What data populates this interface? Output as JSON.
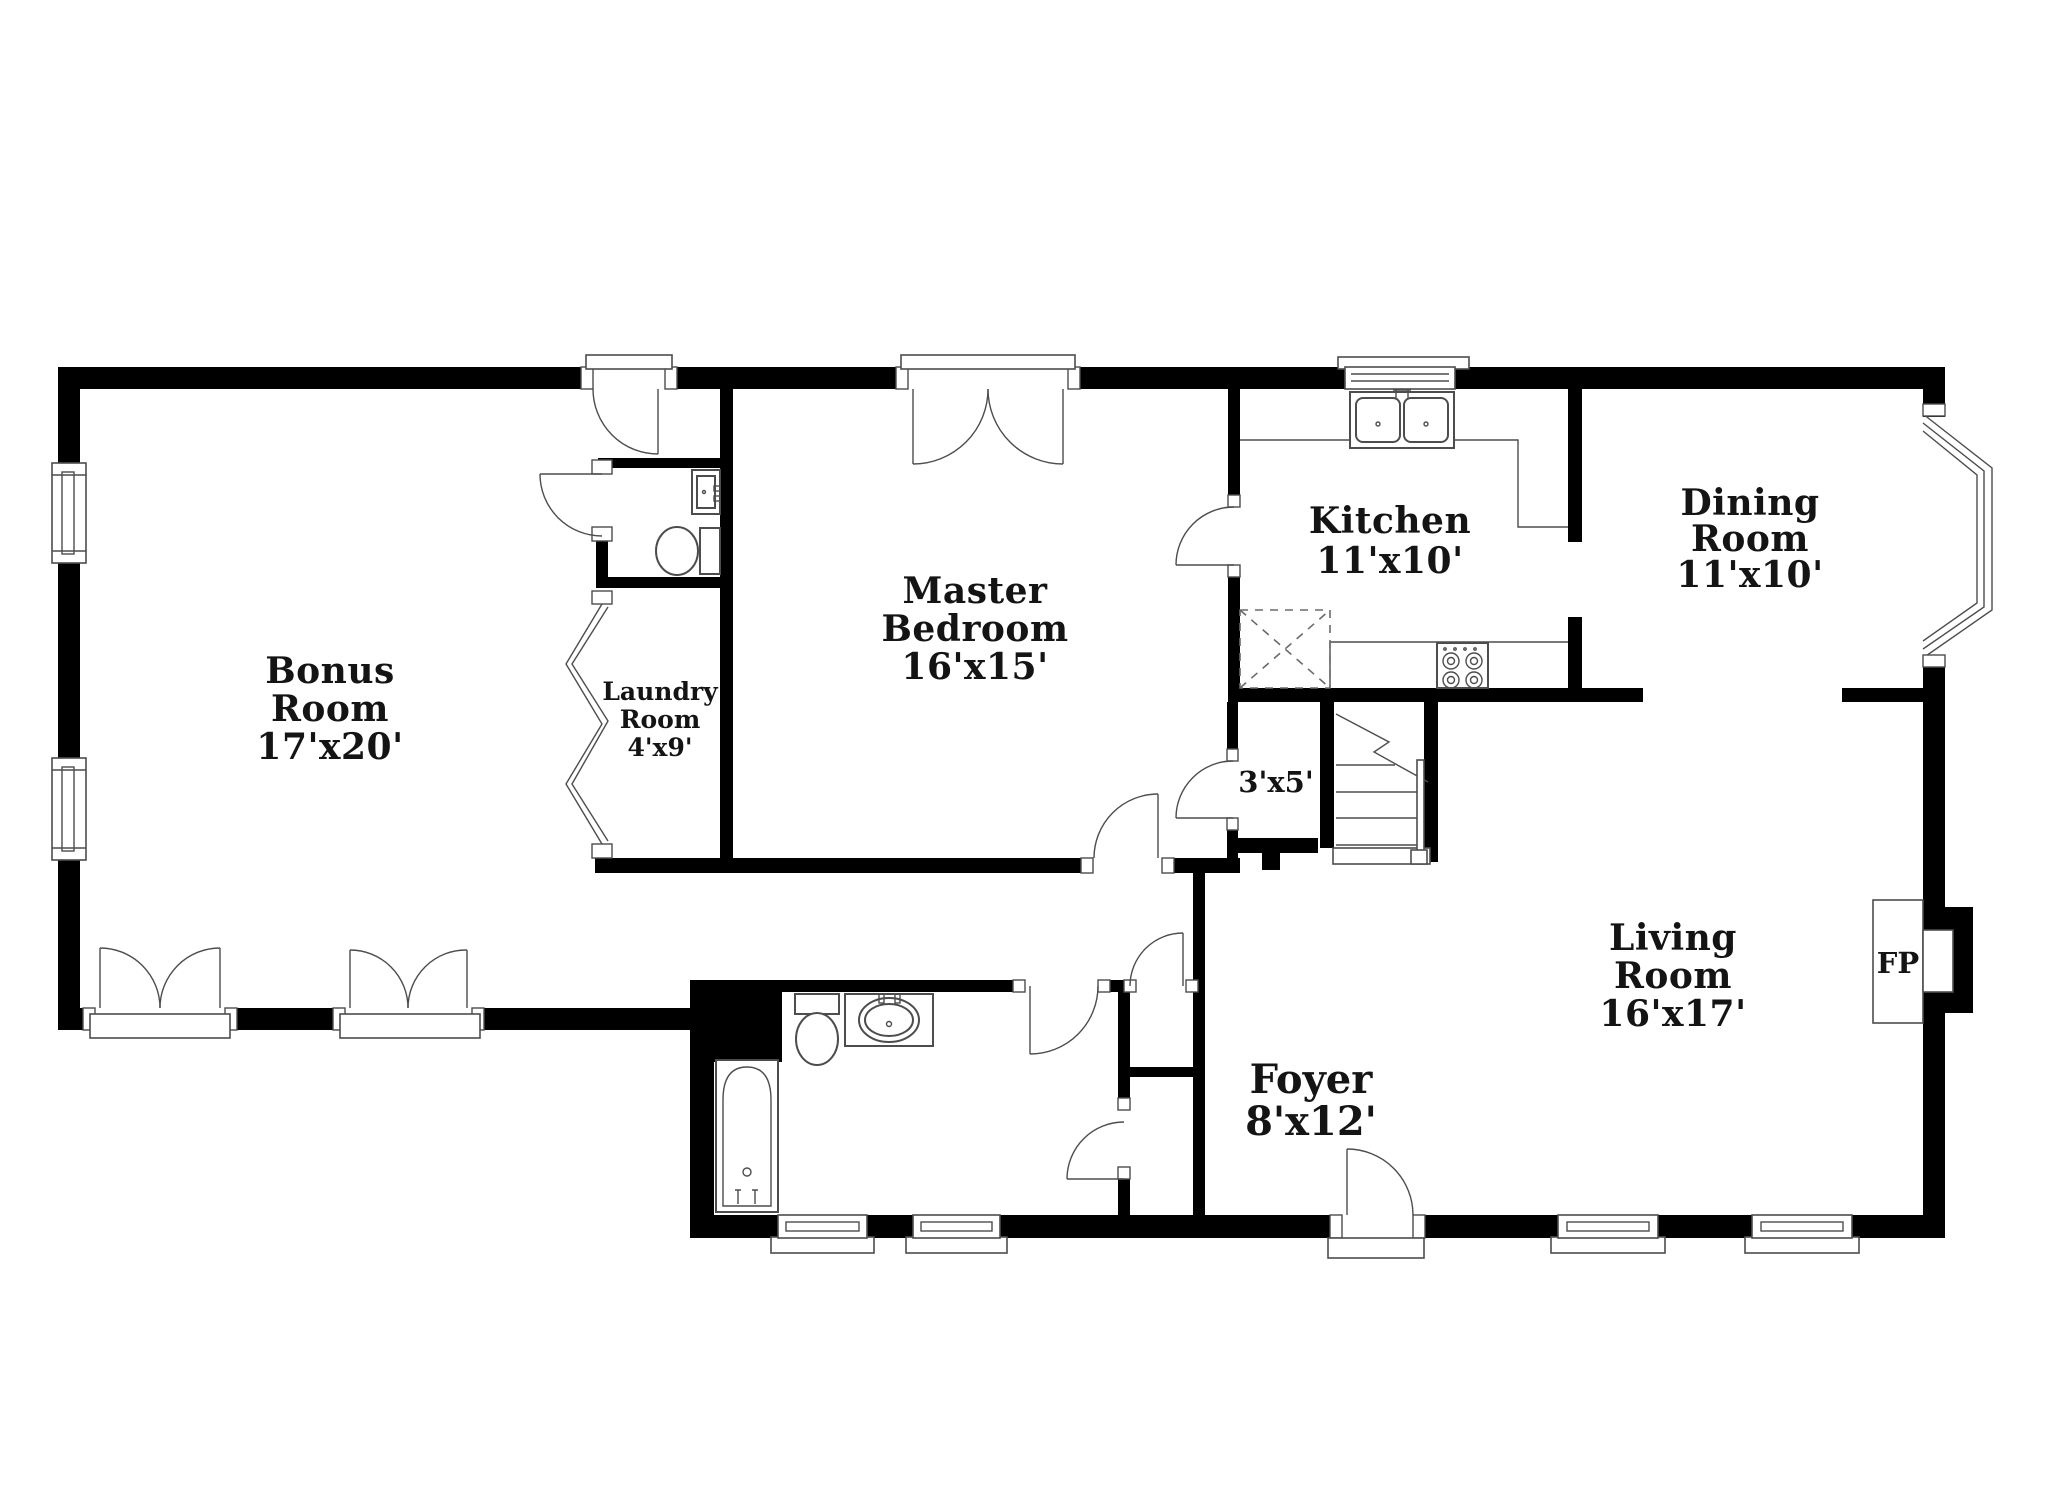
{
  "title": "Floor Plan",
  "rooms": [
    {
      "name": "Bonus Room",
      "size": "17'x20'",
      "lines": [
        "Bonus",
        "Room",
        "17'x20'"
      ]
    },
    {
      "name": "Laundry Room",
      "size": "4'x9'",
      "lines": [
        "Laundry",
        "Room",
        "4'x9'"
      ]
    },
    {
      "name": "Master Bedroom",
      "size": "16'x15'",
      "lines": [
        "Master",
        "Bedroom",
        "16'x15'"
      ]
    },
    {
      "name": "Kitchen",
      "size": "11'x10'",
      "lines": [
        "Kitchen",
        "11'x10'"
      ]
    },
    {
      "name": "Dining Room",
      "size": "11'x10'",
      "lines": [
        "Dining",
        "Room",
        "11'x10'"
      ]
    },
    {
      "name": "Living Room",
      "size": "16'x17'",
      "lines": [
        "Living",
        "Room",
        "16'x17'"
      ]
    },
    {
      "name": "Foyer",
      "size": "8'x12'",
      "lines": [
        "Foyer",
        "8'x12'"
      ]
    },
    {
      "name": "Closet",
      "size": "3'x5'",
      "lines": [
        "3'x5'"
      ]
    },
    {
      "name": "Fireplace",
      "size": "",
      "lines": [
        "FP"
      ]
    }
  ],
  "fixtures": [
    "kitchen-double-sink",
    "range-cooktop",
    "pantry",
    "refrigerator-counter",
    "powder-sink",
    "powder-toilet",
    "bathroom-toilet",
    "bathroom-vanity-sink",
    "bathtub",
    "staircase",
    "fireplace",
    "bay-window",
    "bifold-doors",
    "french-doors"
  ],
  "colors": {
    "walls": "#000000",
    "lines": "#4d4d4d",
    "text": "#141414",
    "background": "#ffffff"
  }
}
